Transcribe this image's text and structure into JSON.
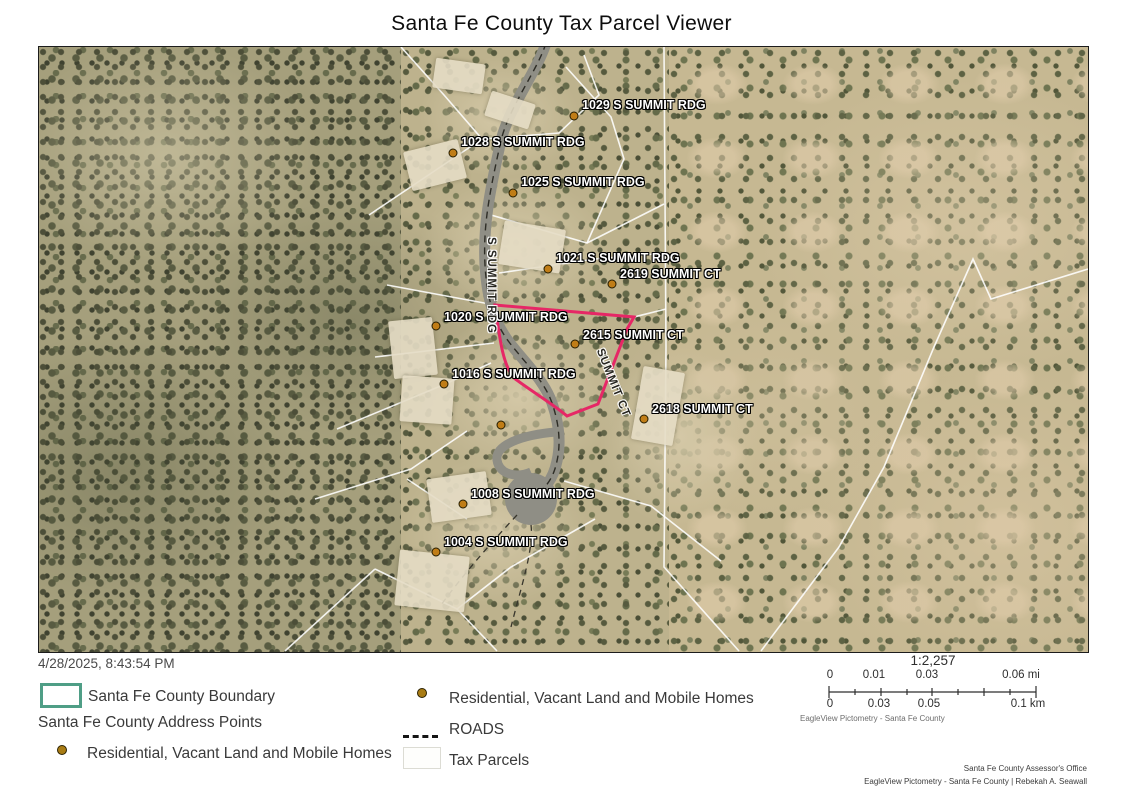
{
  "title": "Santa Fe County Tax Parcel Viewer",
  "timestamp": "4/28/2025, 8:43:54 PM",
  "map": {
    "highlight_color": "#e62766",
    "address_labels": [
      {
        "text": "1029 S SUMMIT RDG",
        "dot": [
          535,
          69
        ],
        "label": [
          543,
          51
        ]
      },
      {
        "text": "1028 S SUMMIT RDG",
        "dot": [
          414,
          106
        ],
        "label": [
          422,
          88
        ]
      },
      {
        "text": "1025 S SUMMIT RDG",
        "dot": [
          474,
          146
        ],
        "label": [
          482,
          128
        ]
      },
      {
        "text": "1021 S SUMMIT RDG",
        "dot": [
          509,
          222
        ],
        "label": [
          517,
          204
        ]
      },
      {
        "text": "2619 SUMMIT CT",
        "dot": [
          573,
          237
        ],
        "label": [
          581,
          220
        ]
      },
      {
        "text": "1020 S SUMMIT RDG",
        "dot": [
          397,
          279
        ],
        "label": [
          405,
          263
        ]
      },
      {
        "text": "2615 SUMMIT CT",
        "dot": [
          536,
          297
        ],
        "label": [
          544,
          281
        ]
      },
      {
        "text": "1016 S SUMMIT RDG",
        "dot": [
          405,
          337
        ],
        "label": [
          413,
          320
        ]
      },
      {
        "text": "2618 SUMMIT CT",
        "dot": [
          605,
          372
        ],
        "label": [
          613,
          355
        ]
      },
      {
        "text": "1008 S SUMMIT RDG",
        "dot": [
          424,
          457
        ],
        "label": [
          432,
          440
        ]
      },
      {
        "text": "1004 S SUMMIT RDG",
        "dot": [
          397,
          505
        ],
        "label": [
          405,
          488
        ]
      }
    ],
    "unlabeled_points": [
      [
        462,
        378
      ]
    ],
    "road_labels": [
      {
        "text": "S SUMMIT RDG",
        "x": 458,
        "y": 190,
        "rotation": 90
      },
      {
        "text": "SUMMIT CT",
        "x": 566,
        "y": 300,
        "rotation": 68
      }
    ]
  },
  "legend": {
    "boundary_label": "Santa Fe County Boundary",
    "boundary_color": "#4f9e86",
    "address_points_header": "Santa Fe County Address Points",
    "residential_label": "Residential, Vacant Land and Mobile Homes",
    "residential_point_color": "#a97c14",
    "roads_label": "ROADS",
    "tax_parcels_label": "Tax Parcels"
  },
  "scalebar": {
    "ratio": "1:2,257",
    "mi": [
      "0",
      "0.01",
      "0.03",
      "0.06 mi"
    ],
    "km": [
      "0",
      "0.03",
      "0.05",
      "0.1 km"
    ],
    "attribution": "EagleView Pictometry - Santa Fe County"
  },
  "credits": {
    "line1": "Santa Fe County Assessor's Office",
    "line2": "EagleView Pictometry - Santa Fe County | Rebekah A. Seawall"
  }
}
